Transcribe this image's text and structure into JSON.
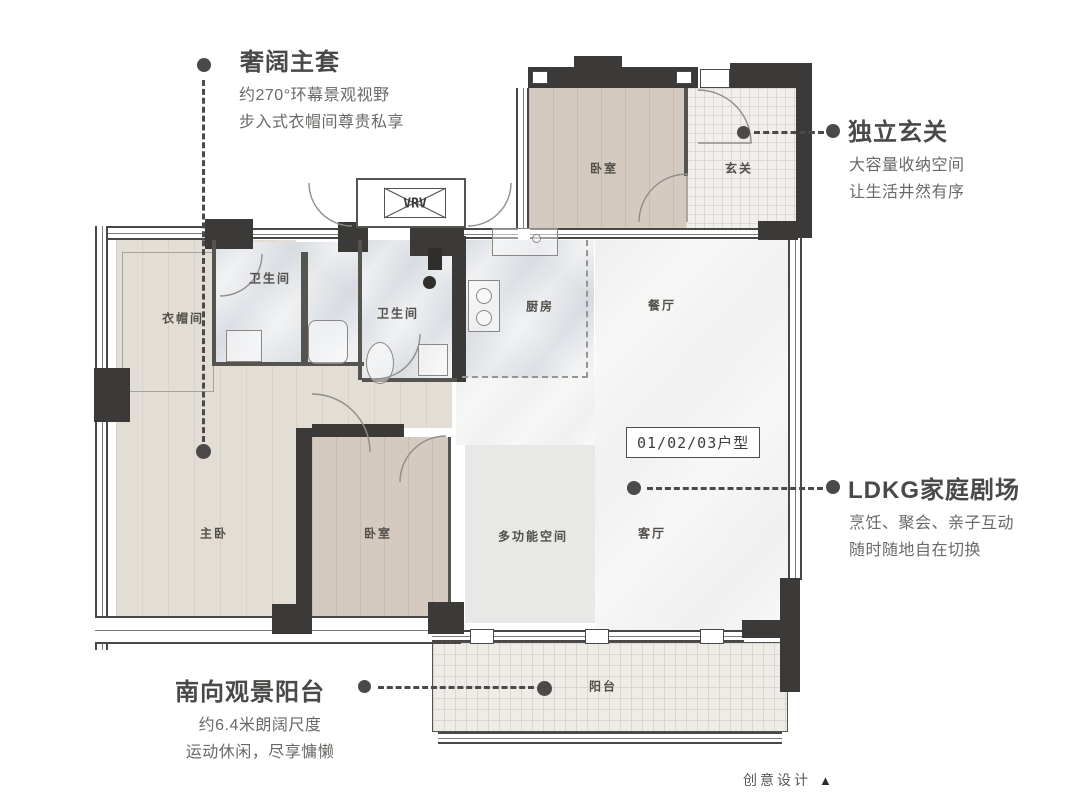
{
  "unit_label": "01/02/03户型",
  "credit": {
    "text": "创意设计",
    "icon": "▲"
  },
  "annotations": {
    "master_suite": {
      "title": "奢阔主套",
      "desc1": "约270°环幕景观视野",
      "desc2": "步入式衣帽间尊贵私享"
    },
    "entry": {
      "title": "独立玄关",
      "desc1": "大容量收纳空间",
      "desc2": "让生活井然有序"
    },
    "ldkg": {
      "title": "LDKG家庭剧场",
      "desc1": "烹饪、聚会、亲子互动",
      "desc2": "随时随地自在切换"
    },
    "balcony": {
      "title": "南向观景阳台",
      "desc1": "约6.4米朗阔尺度",
      "desc2": "运动休闲，尽享慵懒"
    }
  },
  "rooms": {
    "bedroom_top": "卧室",
    "entry_hall": "玄关",
    "vrv": "VRV",
    "cloakroom": "衣帽间",
    "bathroom_master": "卫生间",
    "bathroom_second": "卫生间",
    "kitchen": "厨房",
    "dining": "餐厅",
    "master_bedroom": "主卧",
    "bedroom_second": "卧室",
    "multifunction": "多功能空间",
    "living": "客厅",
    "balcony": "阳台"
  },
  "colors": {
    "wall": "#3b3a38",
    "title_text": "#4b4947",
    "body_text": "#6b6966",
    "wood": "#d4cabf",
    "marble": "#f2f3f4",
    "tile": "#f0efeb"
  }
}
